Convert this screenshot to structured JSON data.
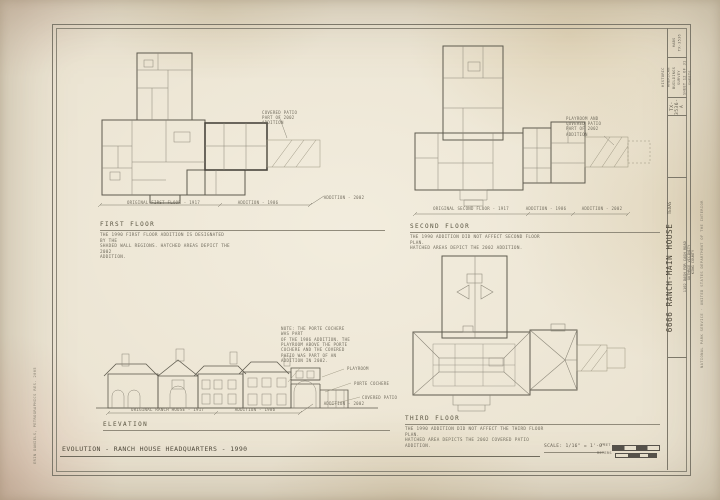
{
  "sheet": {
    "main_title": "EVOLUTION - RANCH HOUSE HEADQUARTERS - 1990",
    "scale_label": "SCALE: 1/16\" = 1'-0\"",
    "feet_label": "FEET",
    "meters_label": "METERS",
    "left_margin_credit": "ERIN DANIELS, PETROGRAPHICS RES. 2005",
    "right_margin_credit": "NATIONAL PARK SERVICE · UNITED STATES DEPARTMENT OF THE INTERIOR"
  },
  "title_block": {
    "call_number": "HABS\nTX-3536",
    "survey_heading": "HISTORIC AMERICAN\nBUILDINGS SURVEY\nSHEET 12 OF 31 SHEETS",
    "survey_number": "TX-3536-A",
    "structure_name": "6666 RANCH-MAIN HOUSE",
    "structure_address": "1102 DASH FOR CASH ROAD",
    "structure_city": "GUTHRIE VICINITY",
    "structure_county": "KING COUNTY",
    "structure_state": "TEXAS"
  },
  "first_floor": {
    "heading": "FIRST FLOOR",
    "note": "THE 1990 FIRST FLOOR ADDITION IS DESIGNATED BY THE\nSHADED WALL REGIONS. HATCHED AREAS DEPICT THE 2002\nADDITION.",
    "patio_note": "COVERED PATIO\nPART OF 2002\nADDITION",
    "dim_original": "ORIGINAL FIRST FLOOR - 1917",
    "dim_addition1": "ADDITION - 1986",
    "dim_addition2": "ADDITION - 2002"
  },
  "second_floor": {
    "heading": "SECOND FLOOR",
    "note": "THE 1990 ADDITION DID NOT AFFECT SECOND FLOOR PLAN.\nHATCHED AREAS DEPICT THE 2002 ADDITION.",
    "playroom_note": "PLAYROOM AND\nCOVERED PATIO\nPART OF 2002\nADDITION",
    "dim_original": "ORIGINAL SECOND FLOOR - 1917",
    "dim_addition1": "ADDITION - 1986",
    "dim_addition2": "ADDITION - 2002"
  },
  "third_floor": {
    "heading": "THIRD FLOOR",
    "note": "THE 1990 ADDITION DID NOT AFFECT THE THIRD FLOOR PLAN.\nHATCHED AREA DEPICTS THE 2002 COVERED PATIO ADDITION."
  },
  "elevation": {
    "heading": "ELEVATION",
    "note": "NOTE: THE PORTE COCHERE WAS PART\nOF THE 1986 ADDITION. THE\nPLAYROOM ABOVE THE PORTE\nCOCHERE AND THE COVERED\nPATIO WAS PART OF AN\nADDITION IN 2002.",
    "label_playroom": "PLAYROOM",
    "label_porte_cochere": "PORTE COCHERE",
    "label_covered_patio": "COVERED PATIO",
    "dim_original": "ORIGINAL RANCH HOUSE - 1917",
    "dim_addition1": "ADDITION - 1986",
    "dim_addition2": "ADDITION - 2002"
  }
}
